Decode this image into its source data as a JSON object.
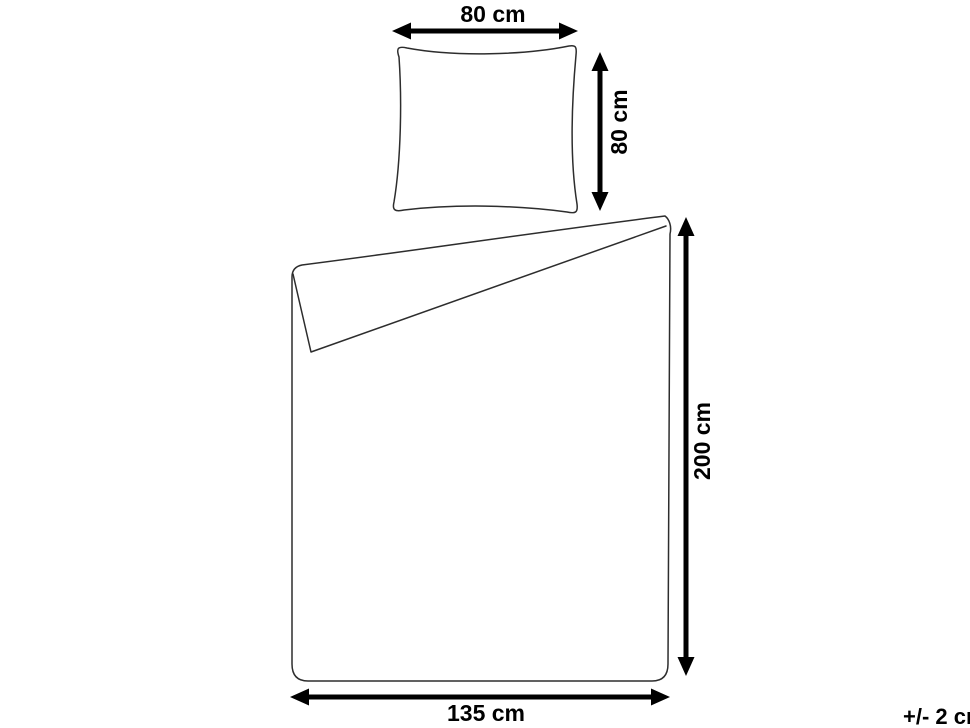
{
  "diagram": {
    "background_color": "#ffffff",
    "outline_color": "#2d2d2d",
    "dimension_color": "#000000",
    "pillow": {
      "width_label": "80 cm",
      "height_label": "80 cm"
    },
    "duvet": {
      "height_label": "200 cm",
      "width_label": "135 cm"
    },
    "tolerance_label": "+/- 2 cm"
  }
}
